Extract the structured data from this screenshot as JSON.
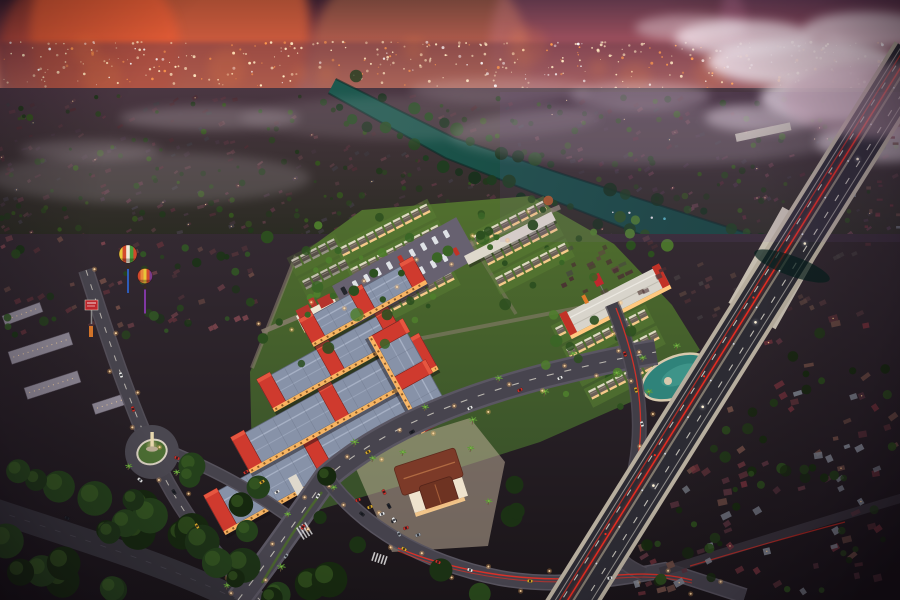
{
  "meta": {
    "scene_title": "Aerial dusk rendering of a riverside township development",
    "render_type": "architectural-visualization",
    "view": "aerial-oblique",
    "time_of_day": "dusk"
  },
  "palette": {
    "sky_top": "#3a1f2e",
    "sky_red": "#91424a",
    "sky_glow": "#d97f6e",
    "sky_pink": "#e9ad9a",
    "sky_haze": "#a8879b",
    "cloud": "#f2e4ec",
    "city_band": "#6a3c48",
    "city_light_warm": "#ffe9c2",
    "city_light_orange": "#ff9a4e",
    "city_light_white": "#ffffff",
    "mid_top": "#4a3642",
    "mid_bottom": "#2a2b22",
    "ground_top": "#342a32",
    "ground_bottom": "#191418",
    "river": "#1e5a50",
    "river_deep": "#113833",
    "river_edge": "#0d2a26",
    "highway_edge": "#b7ae9e",
    "highway_asphalt": "#2c2b33",
    "highway_median": "#8b8274",
    "lane_white": "#e6e2d6",
    "taillight_red": "#ff2d1f",
    "headlight_white": "#fff3d8",
    "highway_lamp": "#e8eeff",
    "road_asphalt": "#47444e",
    "road_edge": "#5a5662",
    "arc_road": "#343239",
    "commercial_roof": "#8792a8",
    "commercial_ridge": "#aeb8cc",
    "accent_red": "#cf3a2e",
    "accent_red_lit": "#e85a42",
    "wall_warm": "#ffb964",
    "window_dark": "#7a4a1a",
    "lawn": "#40592a",
    "lawn_light": "#5a7e34",
    "lane_path": "#877c6c",
    "rowhouse_wall": "#ece4d2",
    "rowhouse_roof": "#6b6157",
    "rowhouse_lit": "#ffcf8f",
    "clubhouse_roof": "#7c3a28",
    "clubhouse_ridge": "#b06a42",
    "clubhouse_wall": "#efe3cd",
    "plaza": "#c7b6a0",
    "lagoon": "#2f837a",
    "lagoon_light": "#49a093",
    "sand": "#d8c9ae",
    "statue": "#e8d8ae",
    "palm_frond": "#5f9c37",
    "tree_dark": "#1d3317",
    "tree_mid": "#33541f",
    "tree_light": "#5d8a31",
    "tree_autumn": "#b35a2a",
    "banner_red": "#c0272d",
    "balloon_blue_pennant": "#2f63c8",
    "canopy_white": "#ded8cc",
    "apartment_wall": "#8d8794"
  },
  "scene": {
    "description": "Dusk aerial view of a new township: a lit commercial shophouse complex with red accents, fan-shaped white rowhouse clusters, a clubhouse, a statue roundabout and a palm boulevard, bounded by a teal river and an elevated highway with red taillight trails; endless suburban sprawl and a glowing city skyline under a pink sunset with clouds; two hot-air balloons float over the older estate.",
    "elements": [
      {
        "name": "sunset-sky",
        "desc": "pink-orange dusk sky with purple haze"
      },
      {
        "name": "distant-city-lights",
        "desc": "glittering skyline lights on horizon"
      },
      {
        "name": "clouds",
        "desc": "white cloud bank on the right"
      },
      {
        "name": "suburban-sprawl",
        "desc": "dark red rooftops and trees to the horizon"
      },
      {
        "name": "river",
        "desc": "teal river crossing diagonally, dotted with boats"
      },
      {
        "name": "elevated-highway",
        "desc": "toll road with red taillight trails and bridge over river"
      },
      {
        "name": "commercial-shophouse-complex",
        "desc": "blue-grey roofs, red parapets, warm lit arcades"
      },
      {
        "name": "rowhouse-clusters",
        "desc": "white terraced houses in diagonal rows on lawns"
      },
      {
        "name": "clubhouse",
        "desc": "terracotta hip-roof building with plaza parking"
      },
      {
        "name": "roundabout-statue",
        "desc": "oval island with white statue"
      },
      {
        "name": "lagoon-pool",
        "desc": "free-form pool with sand rim and palms"
      },
      {
        "name": "boulevard",
        "desc": "palm-lined main road with streetlights and cars"
      },
      {
        "name": "hot-air-balloons",
        "desc": "two striped balloons with pennants"
      },
      {
        "name": "billboard",
        "desc": "red cube billboard by the west road"
      },
      {
        "name": "kampung-village",
        "desc": "dense existing village east of the highway"
      },
      {
        "name": "apartment-blocks",
        "desc": "grey walk-up blocks at far west"
      }
    ]
  },
  "sky": {
    "glows": [
      [
        170,
        30,
        140,
        "#ff6f35",
        0.55
      ],
      [
        420,
        62,
        110,
        "#ff9a55",
        0.3
      ],
      [
        620,
        46,
        130,
        "#e08aa8",
        0.22
      ],
      [
        840,
        26,
        120,
        "#c87ba8",
        0.28
      ],
      [
        90,
        50,
        90,
        "#ff5a2a",
        0.4
      ]
    ],
    "clouds": [
      [
        745,
        38,
        70,
        18,
        0.75
      ],
      [
        802,
        62,
        95,
        24,
        0.85
      ],
      [
        868,
        30,
        65,
        18,
        0.7
      ],
      [
        845,
        98,
        85,
        24,
        0.8
      ],
      [
        886,
        142,
        70,
        20,
        0.6
      ],
      [
        760,
        118,
        55,
        14,
        0.45
      ],
      [
        690,
        28,
        55,
        13,
        0.4
      ],
      [
        640,
        96,
        70,
        14,
        0.3
      ],
      [
        210,
        118,
        90,
        12,
        0.22
      ],
      [
        90,
        150,
        70,
        10,
        0.2
      ],
      [
        500,
        90,
        90,
        12,
        0.18
      ]
    ],
    "haze": [
      [
        150,
        178,
        160,
        26,
        0.16
      ],
      [
        650,
        135,
        200,
        30,
        0.2
      ],
      [
        420,
        118,
        180,
        22,
        0.12
      ]
    ]
  },
  "procedural": {
    "seed": 7,
    "city_light_count": 430,
    "sprawl_house_count": 330,
    "sprawl_tree_count": 200,
    "sprawl_roof_colors": [
      "#4e2e35",
      "#573640",
      "#463640",
      "#5f3f46",
      "#3f3a40"
    ],
    "village": {
      "house_count": 85,
      "tree_count": 60,
      "ne_count": 16,
      "west_band_count": 48,
      "roof_colors": [
        "#5d3138",
        "#6b4a42",
        "#7c818c",
        "#6e3039",
        "#55313b"
      ]
    },
    "left_suburb": {
      "house_count": 46,
      "tree_count": 30,
      "roof_colors": [
        "#5a3038",
        "#4e3238",
        "#6b4a44",
        "#75424a"
      ]
    },
    "estate_tree_count": 44,
    "bigtree_count": 34
  },
  "river": {
    "centerline": [
      [
        332,
        86
      ],
      [
        450,
        148
      ],
      [
        560,
        188
      ],
      [
        650,
        220
      ],
      [
        740,
        252
      ],
      [
        830,
        282
      ],
      [
        902,
        308
      ]
    ],
    "deco_count": 14,
    "deco_colors": [
      "#b05ad0",
      "#e85a4a",
      "#f0e8ee",
      "#58b8c8"
    ]
  },
  "rows": {
    "angle": -27,
    "step": 10,
    "w": 8,
    "h": 5,
    "bright": {
      "wall": "#ece4d2",
      "roof": "#6b6157",
      "lit": "#ffcf8f"
    },
    "dim": {
      "wall": "#cfc9bd",
      "roof": "#575049",
      "lit": "#9a948a"
    },
    "list": [
      {
        "x": 340,
        "y": 250,
        "n": 10,
        "k": "bright"
      },
      {
        "x": 351,
        "y": 271,
        "n": 10,
        "k": "bright"
      },
      {
        "x": 362,
        "y": 292,
        "n": 10,
        "k": "bright"
      },
      {
        "x": 373,
        "y": 313,
        "n": 9,
        "k": "bright"
      },
      {
        "x": 474,
        "y": 238,
        "n": 8,
        "k": "bright"
      },
      {
        "x": 485,
        "y": 259,
        "n": 8,
        "k": "bright"
      },
      {
        "x": 496,
        "y": 280,
        "n": 8,
        "k": "bright"
      },
      {
        "x": 556,
        "y": 330,
        "n": 9,
        "k": "bright"
      },
      {
        "x": 567,
        "y": 351,
        "n": 9,
        "k": "bright"
      },
      {
        "x": 578,
        "y": 372,
        "n": 9,
        "k": "bright"
      },
      {
        "x": 589,
        "y": 393,
        "n": 7,
        "k": "bright"
      },
      {
        "x": 292,
        "y": 262,
        "n": 5,
        "k": "dim"
      },
      {
        "x": 303,
        "y": 283,
        "n": 5,
        "k": "dim"
      }
    ]
  },
  "commercial": {
    "bars": [
      {
        "x": 205,
        "y": 498,
        "len": 240,
        "w": 38
      },
      {
        "x": 232,
        "y": 440,
        "len": 215,
        "w": 34
      },
      {
        "x": 258,
        "y": 382,
        "len": 150,
        "w": 30
      },
      {
        "x": 300,
        "y": 322,
        "len": 130,
        "w": 24
      },
      {
        "x": 400,
        "y": 320,
        "len": 110,
        "w": 32,
        "angle": 61
      }
    ],
    "parking": {
      "x": 332,
      "y": 286,
      "rot": -29,
      "wd": 142,
      "ht": 46,
      "cars_per_row": 10
    }
  },
  "roads": {
    "streetlight_paths": [
      [
        [
          238,
          599
        ],
        [
          300,
          525
        ],
        [
          325,
          478
        ],
        [
          430,
          425
        ],
        [
          540,
          382
        ],
        [
          648,
          352
        ]
      ],
      [
        [
          86,
          272
        ],
        [
          118,
          368
        ],
        [
          152,
          452
        ],
        [
          210,
          545
        ],
        [
          258,
          599
        ]
      ],
      [
        [
          612,
          306
        ],
        [
          640,
          380
        ],
        [
          648,
          450
        ],
        [
          622,
          508
        ]
      ],
      [
        [
          262,
          332
        ],
        [
          420,
          268
        ],
        [
          560,
          208
        ]
      ],
      [
        [
          326,
          477
        ],
        [
          420,
          562
        ],
        [
          520,
          582
        ],
        [
          640,
          574
        ],
        [
          745,
          596
        ]
      ]
    ]
  },
  "highway": {
    "white_dots_t": [
      0.18,
      0.33,
      0.47,
      0.62,
      0.76
    ],
    "red_dots_t": [
      0.22,
      0.44,
      0.58,
      0.72,
      0.86
    ],
    "lamp_t_start": 0.06,
    "lamp_t_end": 0.96,
    "lamp_step": 0.065
  },
  "cars": [
    {
      "x": 286,
      "y": 556,
      "a": -52,
      "c": "#9aa0a8"
    },
    {
      "x": 303,
      "y": 527,
      "a": -55,
      "c": "#c8322b"
    },
    {
      "x": 318,
      "y": 496,
      "a": -58,
      "c": "#e8e8e8"
    },
    {
      "x": 368,
      "y": 452,
      "a": -30,
      "c": "#d8a92c"
    },
    {
      "x": 412,
      "y": 432,
      "a": -29,
      "c": "#23252c"
    },
    {
      "x": 470,
      "y": 408,
      "a": -27,
      "c": "#e8e8e8"
    },
    {
      "x": 520,
      "y": 390,
      "a": -26,
      "c": "#c8322b"
    },
    {
      "x": 560,
      "y": 378,
      "a": -25,
      "c": "#e8e8e8"
    },
    {
      "x": 362,
      "y": 514,
      "a": 37,
      "c": "#23252c"
    },
    {
      "x": 404,
      "y": 549,
      "a": 28,
      "c": "#d8a92c"
    },
    {
      "x": 438,
      "y": 562,
      "a": 22,
      "c": "#c8322b"
    },
    {
      "x": 470,
      "y": 570,
      "a": 17,
      "c": "#e8e8e8"
    },
    {
      "x": 530,
      "y": 581,
      "a": 5,
      "c": "#d8a92c"
    },
    {
      "x": 610,
      "y": 578,
      "a": -8,
      "c": "#e8e8e8"
    },
    {
      "x": 358,
      "y": 500,
      "a": -20,
      "c": "#c8322b"
    },
    {
      "x": 370,
      "y": 507,
      "a": -20,
      "c": "#d8a92c"
    },
    {
      "x": 382,
      "y": 514,
      "a": -20,
      "c": "#e8e8e8"
    },
    {
      "x": 394,
      "y": 521,
      "a": -20,
      "c": "#23252c"
    },
    {
      "x": 406,
      "y": 528,
      "a": -20,
      "c": "#c8322b"
    },
    {
      "x": 418,
      "y": 535,
      "a": -20,
      "c": "#9aa0a8"
    },
    {
      "x": 121,
      "y": 375,
      "a": 72,
      "c": "#e8e8e8"
    },
    {
      "x": 133,
      "y": 409,
      "a": 70,
      "c": "#c8322b"
    },
    {
      "x": 174,
      "y": 492,
      "a": 60,
      "c": "#23252c"
    },
    {
      "x": 197,
      "y": 526,
      "a": 58,
      "c": "#d8a92c"
    },
    {
      "x": 177,
      "y": 458,
      "a": 20,
      "c": "#c8322b"
    },
    {
      "x": 140,
      "y": 480,
      "a": 40,
      "c": "#e8e8e8"
    },
    {
      "x": 246,
      "y": 472,
      "a": -32,
      "c": "#c8322b"
    },
    {
      "x": 262,
      "y": 482,
      "a": -32,
      "c": "#d8a92c"
    },
    {
      "x": 277,
      "y": 492,
      "a": -32,
      "c": "#e8e8e8"
    },
    {
      "x": 625,
      "y": 354,
      "a": 70,
      "c": "#c8322b"
    },
    {
      "x": 636,
      "y": 390,
      "a": 72,
      "c": "#d8a92c"
    },
    {
      "x": 642,
      "y": 424,
      "a": 75,
      "c": "#e8e8e8"
    },
    {
      "x": 384,
      "y": 492,
      "a": 62,
      "c": "#c8322b"
    },
    {
      "x": 389,
      "y": 506,
      "a": 62,
      "c": "#23252c"
    },
    {
      "x": 394,
      "y": 520,
      "a": 62,
      "c": "#e8e8e8"
    },
    {
      "x": 399,
      "y": 534,
      "a": 62,
      "c": "#9aa0a8"
    },
    {
      "x": 67,
      "y": 518,
      "a": -155,
      "c": "#23252c"
    }
  ],
  "balloons": [
    {
      "x": 128,
      "y": 254,
      "r": 9,
      "stripes": [
        "#e7c63a",
        "#d24a2c",
        "#f0ead8",
        "#4a9a3a",
        "#d24a2c"
      ],
      "pennant": "#2f63c8"
    },
    {
      "x": 145,
      "y": 276,
      "r": 7.5,
      "stripes": [
        "#d24a2c",
        "#e7893a",
        "#e7c63a",
        "#d24a2c",
        "#7a3a8a"
      ],
      "pennant": "#8a3ab0"
    }
  ],
  "billboard": {
    "x": 85,
    "y": 300,
    "w": 13,
    "h": 10,
    "color": "#c0272d",
    "pole": "#8a8a8a"
  },
  "apartments": [
    [
      8,
      352,
      64,
      13,
      -18
    ],
    [
      24,
      388,
      56,
      12,
      -18
    ],
    [
      92,
      404,
      42,
      11,
      -18
    ],
    [
      2,
      316,
      40,
      10,
      -20
    ]
  ]
}
